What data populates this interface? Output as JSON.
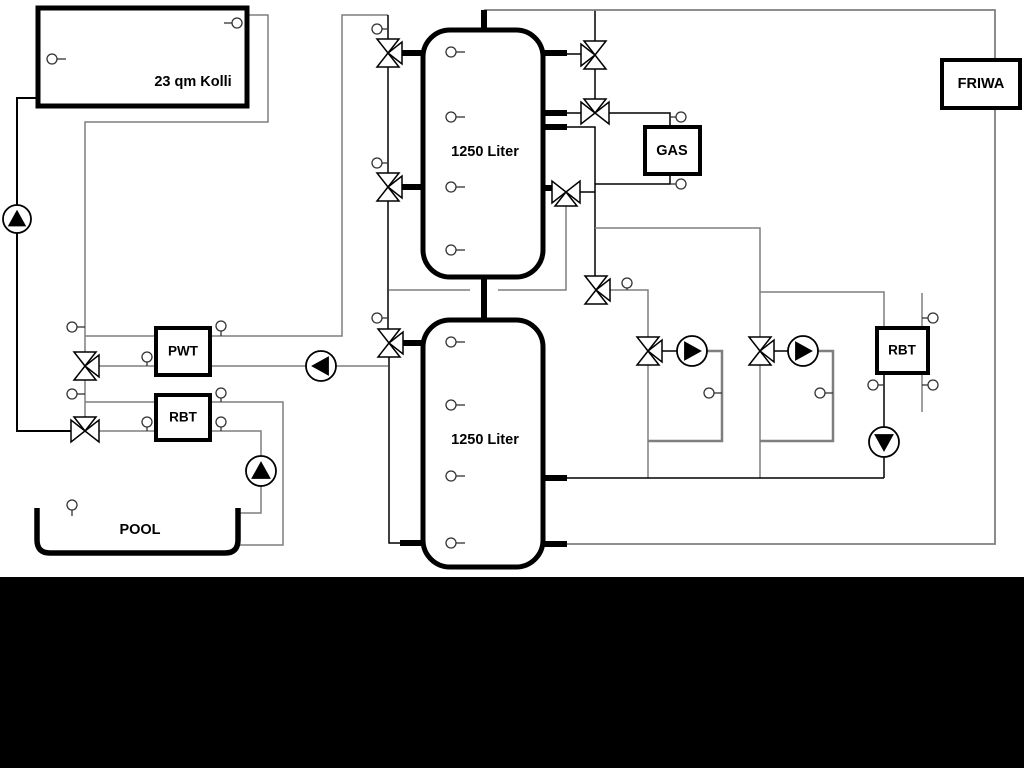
{
  "canvas": {
    "width": 1024,
    "height": 768,
    "background": "#ffffff",
    "letterbox_top": 577,
    "letterbox_color": "#000000"
  },
  "palette": {
    "gray": "#7f7f7f",
    "black": "#000000",
    "white": "#ffffff",
    "sensor_stroke": "#333333"
  },
  "boxes": [
    {
      "id": "collector",
      "label": "23 qm Kolli",
      "x": 38,
      "y": 8,
      "w": 209,
      "h": 98,
      "rx": 0,
      "stroke": 5,
      "label_x": 193,
      "label_y": 82,
      "font": 14.5
    },
    {
      "id": "tank1",
      "label": "1250 Liter",
      "x": 423,
      "y": 30,
      "w": 120,
      "h": 247,
      "rx": 27,
      "stroke": 5,
      "label_x": 485,
      "label_y": 152,
      "font": 14.5
    },
    {
      "id": "tank2",
      "label": "1250 Liter",
      "x": 423,
      "y": 320,
      "w": 120,
      "h": 247,
      "rx": 27,
      "stroke": 5,
      "label_x": 485,
      "label_y": 440,
      "font": 14.5
    },
    {
      "id": "gas-boiler",
      "label": "GAS",
      "x": 645,
      "y": 127,
      "w": 55,
      "h": 47,
      "rx": 0,
      "stroke": 4,
      "label_x": 672,
      "label_y": 151,
      "font": 14.5
    },
    {
      "id": "friwa-station",
      "label": "FRIWA",
      "x": 942,
      "y": 60,
      "w": 78,
      "h": 48,
      "rx": 0,
      "stroke": 4,
      "label_x": 981,
      "label_y": 84,
      "font": 14.5
    },
    {
      "id": "pwt-exchanger",
      "label": "PWT",
      "x": 156,
      "y": 328,
      "w": 54,
      "h": 47,
      "rx": 0,
      "stroke": 4,
      "label_x": 183,
      "label_y": 351,
      "font": 13.5
    },
    {
      "id": "rbt1-exchanger",
      "label": "RBT",
      "x": 156,
      "y": 395,
      "w": 54,
      "h": 45,
      "rx": 0,
      "stroke": 4,
      "label_x": 183,
      "label_y": 417,
      "font": 13.5
    },
    {
      "id": "rbt2-exchanger",
      "label": "RBT",
      "x": 877,
      "y": 328,
      "w": 51,
      "h": 45,
      "rx": 0,
      "stroke": 4,
      "label_x": 902,
      "label_y": 350,
      "font": 13.5
    }
  ],
  "pool": {
    "id": "pool",
    "label": "POOL",
    "path": "M 37 508 L 37 540 Q 37 553 50 553 L 225 553 Q 238 553 238 540 L 238 508",
    "stroke": 5.5,
    "label_x": 140,
    "label_y": 530,
    "font": 14.5
  },
  "pipes": [
    {
      "id": "solar-supply",
      "pts": [
        [
          38,
          98
        ],
        [
          17,
          98
        ],
        [
          17,
          431
        ],
        [
          71,
          431
        ]
      ],
      "c": "black",
      "w": 2
    },
    {
      "id": "solar-return",
      "pts": [
        [
          247,
          15
        ],
        [
          268,
          15
        ],
        [
          268,
          122
        ],
        [
          85,
          122
        ],
        [
          85,
          352
        ]
      ],
      "c": "gray",
      "w": 1.5
    },
    {
      "id": "solar-riser-lower",
      "pts": [
        [
          85,
          380
        ],
        [
          85,
          417
        ]
      ],
      "c": "gray",
      "w": 1.5
    },
    {
      "id": "pwt-left-top",
      "pts": [
        [
          85,
          336
        ],
        [
          156,
          336
        ]
      ],
      "c": "gray",
      "w": 1.5
    },
    {
      "id": "pwt-left-bottom",
      "pts": [
        [
          99,
          366
        ],
        [
          156,
          366
        ]
      ],
      "c": "gray",
      "w": 1.5
    },
    {
      "id": "pwt-right-top",
      "pts": [
        [
          210,
          336
        ],
        [
          342,
          336
        ],
        [
          342,
          15
        ],
        [
          388,
          15
        ]
      ],
      "c": "gray",
      "w": 1.5
    },
    {
      "id": "pwt-right-bottom",
      "pts": [
        [
          210,
          366
        ],
        [
          388,
          366
        ]
      ],
      "c": "gray",
      "w": 1.5
    },
    {
      "id": "rbt1-left-top",
      "pts": [
        [
          85,
          402
        ],
        [
          156,
          402
        ]
      ],
      "c": "gray",
      "w": 1.5
    },
    {
      "id": "rbt1-left-bottom",
      "pts": [
        [
          99,
          431
        ],
        [
          156,
          431
        ]
      ],
      "c": "gray",
      "w": 1.5
    },
    {
      "id": "rbt1-right-top",
      "pts": [
        [
          210,
          402
        ],
        [
          283,
          402
        ],
        [
          283,
          545
        ],
        [
          240,
          545
        ]
      ],
      "c": "gray",
      "w": 1.5
    },
    {
      "id": "rbt1-right-bottom",
      "pts": [
        [
          210,
          431
        ],
        [
          261,
          431
        ],
        [
          261,
          513
        ],
        [
          240,
          513
        ]
      ],
      "c": "gray",
      "w": 1.5
    },
    {
      "id": "riser-top",
      "pts": [
        [
          388,
          15
        ],
        [
          388,
          39
        ]
      ],
      "c": "black",
      "w": 1.5
    },
    {
      "id": "riser-e-f",
      "pts": [
        [
          388,
          67
        ],
        [
          388,
          173
        ]
      ],
      "c": "black",
      "w": 1.5
    },
    {
      "id": "riser-f-g",
      "pts": [
        [
          388,
          201
        ],
        [
          388,
          329
        ]
      ],
      "c": "black",
      "w": 1.5
    },
    {
      "id": "riser-g-bottom",
      "pts": [
        [
          389,
          357
        ],
        [
          389,
          543
        ],
        [
          401,
          543
        ]
      ],
      "c": "black",
      "w": 1.5
    },
    {
      "id": "mid-line-left",
      "pts": [
        [
          389,
          290
        ],
        [
          470,
          290
        ]
      ],
      "c": "gray",
      "w": 1.5
    },
    {
      "id": "mid-line-right",
      "pts": [
        [
          498,
          290
        ],
        [
          566,
          290
        ],
        [
          566,
          206
        ]
      ],
      "c": "gray",
      "w": 1.5
    },
    {
      "id": "valve-a-riser",
      "pts": [
        [
          595,
          10
        ],
        [
          595,
          41
        ]
      ],
      "c": "black",
      "w": 1.5
    },
    {
      "id": "valve-a-stub-line",
      "pts": [
        [
          567,
          54
        ],
        [
          581,
          54
        ]
      ],
      "c": "black",
      "w": 1.5
    },
    {
      "id": "valve-a-b-link",
      "pts": [
        [
          595,
          69
        ],
        [
          595,
          99
        ]
      ],
      "c": "black",
      "w": 1.5
    },
    {
      "id": "valve-b-stub-line",
      "pts": [
        [
          567,
          113
        ],
        [
          581,
          113
        ]
      ],
      "c": "black",
      "w": 1.5
    },
    {
      "id": "valve-b-gas-top",
      "pts": [
        [
          609,
          113
        ],
        [
          670,
          113
        ],
        [
          670,
          127
        ]
      ],
      "c": "black",
      "w": 1.5
    },
    {
      "id": "tank-gas-riser",
      "pts": [
        [
          567,
          127
        ],
        [
          595,
          127
        ],
        [
          595,
          276
        ]
      ],
      "c": "black",
      "w": 1.5
    },
    {
      "id": "valve-c-link",
      "pts": [
        [
          580,
          192
        ],
        [
          595,
          192
        ]
      ],
      "c": "black",
      "w": 1.5
    },
    {
      "id": "gas-bottom",
      "pts": [
        [
          595,
          184
        ],
        [
          670,
          184
        ],
        [
          670,
          174
        ]
      ],
      "c": "black",
      "w": 1.5
    },
    {
      "id": "branch-circuit2",
      "pts": [
        [
          595,
          228
        ],
        [
          760,
          228
        ],
        [
          760,
          337
        ]
      ],
      "c": "gray",
      "w": 1.5
    },
    {
      "id": "valve-d-circuit1",
      "pts": [
        [
          610,
          290
        ],
        [
          648,
          290
        ],
        [
          648,
          337
        ]
      ],
      "c": "gray",
      "w": 1.5
    },
    {
      "id": "circuit2-rbt2",
      "pts": [
        [
          760,
          292
        ],
        [
          884,
          292
        ],
        [
          884,
          328
        ]
      ],
      "c": "gray",
      "w": 1.5
    },
    {
      "id": "circuit1-conn",
      "pts": [
        [
          662,
          351
        ],
        [
          677,
          351
        ]
      ],
      "c": "black",
      "w": 1.5
    },
    {
      "id": "circuit1-loop",
      "pts": [
        [
          707,
          351
        ],
        [
          722,
          351
        ],
        [
          722,
          441
        ],
        [
          648,
          441
        ]
      ],
      "c": "gray",
      "w": 2.5
    },
    {
      "id": "circuit1-return",
      "pts": [
        [
          648,
          365
        ],
        [
          648,
          478
        ]
      ],
      "c": "gray",
      "w": 1.5
    },
    {
      "id": "circuit2-conn",
      "pts": [
        [
          774,
          351
        ],
        [
          788,
          351
        ]
      ],
      "c": "black",
      "w": 1.5
    },
    {
      "id": "circuit2-loop",
      "pts": [
        [
          818,
          351
        ],
        [
          833,
          351
        ],
        [
          833,
          441
        ],
        [
          760,
          441
        ]
      ],
      "c": "gray",
      "w": 2.5
    },
    {
      "id": "circuit2-return",
      "pts": [
        [
          760,
          365
        ],
        [
          760,
          478
        ]
      ],
      "c": "gray",
      "w": 1.5
    },
    {
      "id": "rbt2-pump-line",
      "pts": [
        [
          884,
          373
        ],
        [
          884,
          478
        ]
      ],
      "c": "black",
      "w": 1.5
    },
    {
      "id": "tank2-return",
      "pts": [
        [
          567,
          478
        ],
        [
          884,
          478
        ]
      ],
      "c": "black",
      "w": 1.5
    },
    {
      "id": "top-friwa-loop",
      "pts": [
        [
          484,
          10
        ],
        [
          995,
          10
        ],
        [
          995,
          544
        ],
        [
          567,
          544
        ]
      ],
      "c": "gray",
      "w": 1.8
    },
    {
      "id": "rbt2-secondary",
      "pts": [
        [
          922,
          293
        ],
        [
          922,
          412
        ]
      ],
      "c": "gray",
      "w": 1.5
    }
  ],
  "stubs": [
    {
      "id": "tank1-top-pipe",
      "pts": [
        [
          484,
          10
        ],
        [
          484,
          33
        ]
      ]
    },
    {
      "id": "tank-bridge-pipe",
      "pts": [
        [
          484,
          275
        ],
        [
          484,
          322
        ]
      ]
    },
    {
      "id": "tank1-left-top-stub",
      "pts": [
        [
          402,
          53
        ],
        [
          425,
          53
        ]
      ]
    },
    {
      "id": "tank1-left-mid-stub",
      "pts": [
        [
          402,
          187
        ],
        [
          425,
          187
        ]
      ]
    },
    {
      "id": "tank2-left-stub",
      "pts": [
        [
          403,
          343
        ],
        [
          425,
          343
        ]
      ]
    },
    {
      "id": "tank2-bottom-left-stub",
      "pts": [
        [
          400,
          543
        ],
        [
          425,
          543
        ]
      ]
    },
    {
      "id": "tank1-right-top-stub",
      "pts": [
        [
          541,
          53
        ],
        [
          567,
          53
        ]
      ]
    },
    {
      "id": "tank1-right-mid1-stub",
      "pts": [
        [
          541,
          113
        ],
        [
          567,
          113
        ]
      ]
    },
    {
      "id": "tank1-right-mid2-stub",
      "pts": [
        [
          541,
          127
        ],
        [
          567,
          127
        ]
      ]
    },
    {
      "id": "tank1-right-low-stub",
      "pts": [
        [
          541,
          188
        ],
        [
          552,
          188
        ]
      ]
    },
    {
      "id": "tank2-right-mid-stub",
      "pts": [
        [
          541,
          478
        ],
        [
          567,
          478
        ]
      ]
    },
    {
      "id": "tank2-right-bottom-stub",
      "pts": [
        [
          541,
          544
        ],
        [
          567,
          544
        ]
      ]
    }
  ],
  "valves": [
    {
      "id": "tank1-left-top-valve",
      "cx": 388,
      "cy": 53,
      "t": "v-r"
    },
    {
      "id": "tank1-left-mid-valve",
      "cx": 388,
      "cy": 187,
      "t": "v-r"
    },
    {
      "id": "tank2-left-valve",
      "cx": 389,
      "cy": 343,
      "t": "v-r"
    },
    {
      "id": "pwt-mix-valve",
      "cx": 85,
      "cy": 366,
      "t": "v-r"
    },
    {
      "id": "rbt1-mix-valve",
      "cx": 85,
      "cy": 431,
      "t": "h-t"
    },
    {
      "id": "tank1-right-top-valve",
      "cx": 595,
      "cy": 55,
      "t": "v-l"
    },
    {
      "id": "gas-top-valve",
      "cx": 595,
      "cy": 113,
      "t": "h-t"
    },
    {
      "id": "gas-bottom-valve",
      "cx": 566,
      "cy": 192,
      "t": "h-b"
    },
    {
      "id": "distribution-valve",
      "cx": 596,
      "cy": 290,
      "t": "v-r"
    },
    {
      "id": "circuit1-valve",
      "cx": 648,
      "cy": 351,
      "t": "v-r"
    },
    {
      "id": "circuit2-valve",
      "cx": 760,
      "cy": 351,
      "t": "v-r"
    }
  ],
  "pumps": [
    {
      "id": "solar-pump",
      "cx": 17,
      "cy": 219,
      "r": 14,
      "dir": "up"
    },
    {
      "id": "pool-pump",
      "cx": 261,
      "cy": 471,
      "r": 15,
      "dir": "up"
    },
    {
      "id": "pwt-pump",
      "cx": 321,
      "cy": 366,
      "r": 15,
      "dir": "left"
    },
    {
      "id": "circuit1-pump",
      "cx": 692,
      "cy": 351,
      "r": 15,
      "dir": "right"
    },
    {
      "id": "circuit2-pump",
      "cx": 803,
      "cy": 351,
      "r": 15,
      "dir": "right"
    },
    {
      "id": "rbt2-pump",
      "cx": 884,
      "cy": 442,
      "r": 15,
      "dir": "down"
    }
  ],
  "sensors": [
    {
      "id": "collector-low-sensor",
      "cx": 52,
      "cy": 59,
      "tick": "right",
      "to": 66
    },
    {
      "id": "collector-top-sensor",
      "cx": 237,
      "cy": 23,
      "tick": "left",
      "to": 224
    },
    {
      "id": "riser-top-sensor",
      "cx": 377,
      "cy": 29,
      "tick": "right",
      "to": 388
    },
    {
      "id": "riser-mid-sensor",
      "cx": 377,
      "cy": 163,
      "tick": "right",
      "to": 388
    },
    {
      "id": "riser-low-sensor",
      "cx": 377,
      "cy": 318,
      "tick": "right",
      "to": 389
    },
    {
      "id": "solar-line-sensor1",
      "cx": 72,
      "cy": 327,
      "tick": "right",
      "to": 85
    },
    {
      "id": "solar-line-sensor2",
      "cx": 72,
      "cy": 394,
      "tick": "right",
      "to": 85
    },
    {
      "id": "pwt-in-sensor",
      "cx": 147,
      "cy": 357,
      "tick": "down",
      "to": 366
    },
    {
      "id": "pwt-out-top-sensor",
      "cx": 221,
      "cy": 326,
      "tick": "down",
      "to": 336
    },
    {
      "id": "rbt1-in-sensor",
      "cx": 147,
      "cy": 422,
      "tick": "down",
      "to": 431
    },
    {
      "id": "rbt1-out-top-sensor",
      "cx": 221,
      "cy": 393,
      "tick": "down",
      "to": 402
    },
    {
      "id": "rbt1-out-bottom-sensor",
      "cx": 221,
      "cy": 422,
      "tick": "down",
      "to": 431
    },
    {
      "id": "pool-sensor",
      "cx": 72,
      "cy": 505,
      "tick": "down",
      "to": 516
    },
    {
      "id": "tank1-sensor1",
      "cx": 451,
      "cy": 52,
      "tick": "right",
      "to": 465
    },
    {
      "id": "tank1-sensor2",
      "cx": 451,
      "cy": 117,
      "tick": "right",
      "to": 465
    },
    {
      "id": "tank1-sensor3",
      "cx": 451,
      "cy": 187,
      "tick": "right",
      "to": 465
    },
    {
      "id": "tank1-sensor4",
      "cx": 451,
      "cy": 250,
      "tick": "right",
      "to": 465
    },
    {
      "id": "tank2-sensor1",
      "cx": 451,
      "cy": 342,
      "tick": "right",
      "to": 465
    },
    {
      "id": "tank2-sensor2",
      "cx": 451,
      "cy": 405,
      "tick": "right",
      "to": 465
    },
    {
      "id": "tank2-sensor3",
      "cx": 451,
      "cy": 476,
      "tick": "right",
      "to": 465
    },
    {
      "id": "tank2-sensor4",
      "cx": 451,
      "cy": 543,
      "tick": "right",
      "to": 465
    },
    {
      "id": "gas-top-sensor",
      "cx": 681,
      "cy": 117,
      "tick": "left",
      "to": 670
    },
    {
      "id": "gas-bottom-sensor",
      "cx": 681,
      "cy": 184,
      "tick": "left",
      "to": 670
    },
    {
      "id": "distribution-sensor",
      "cx": 627,
      "cy": 283,
      "tick": "down",
      "to": 290
    },
    {
      "id": "circuit1-loop-sensor",
      "cx": 709,
      "cy": 393,
      "tick": "right",
      "to": 722
    },
    {
      "id": "circuit2-loop-sensor",
      "cx": 820,
      "cy": 393,
      "tick": "right",
      "to": 833
    },
    {
      "id": "rbt2-bottom-sensor",
      "cx": 873,
      "cy": 385,
      "tick": "right",
      "to": 884
    },
    {
      "id": "rbt2-sec-top-sensor",
      "cx": 933,
      "cy": 318,
      "tick": "left",
      "to": 922
    },
    {
      "id": "rbt2-sec-bottom-sensor",
      "cx": 933,
      "cy": 385,
      "tick": "left",
      "to": 922
    }
  ]
}
